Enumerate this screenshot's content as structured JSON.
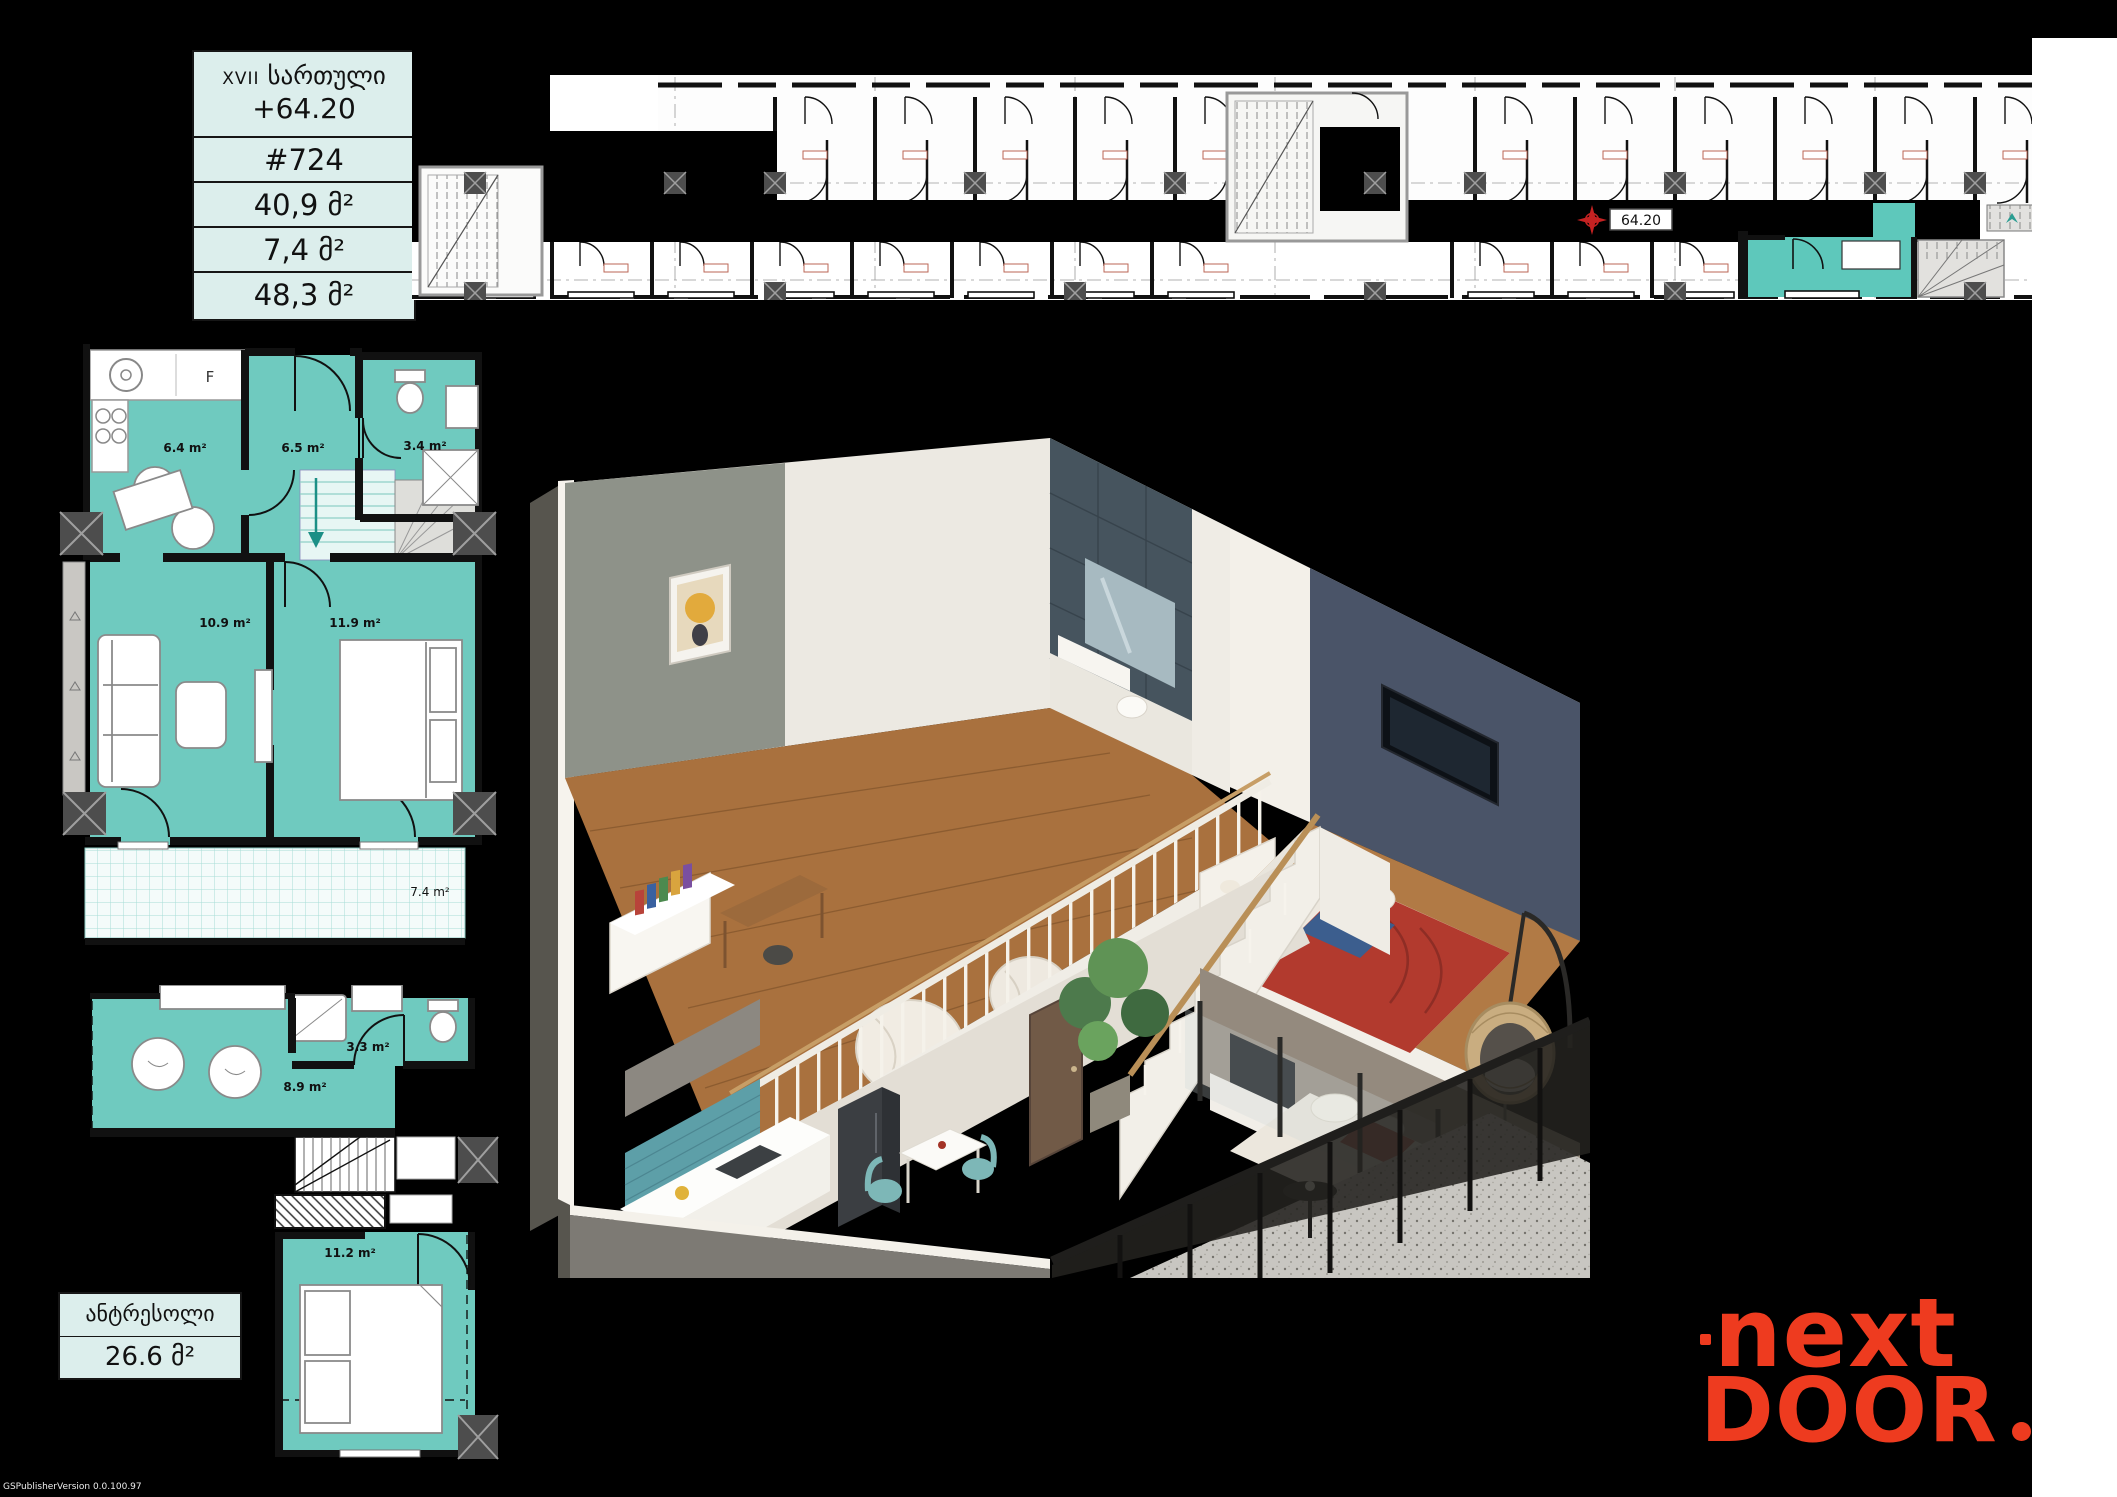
{
  "colors": {
    "teal_room": "#6fcabf",
    "teal_light_bg": "#dceeec",
    "highlight_unit": "#5ec8bb",
    "logo_orange": "#ee3b1f",
    "plan_black": "#111111"
  },
  "info_table": {
    "floor_roman": "XVII",
    "floor_word": "სართული",
    "elevation": "+64.20",
    "rows": [
      {
        "value": "#724"
      },
      {
        "value": "40,9 მ²"
      },
      {
        "value": "7,4 მ²"
      },
      {
        "value": "48,3 მ²"
      }
    ]
  },
  "building_plan": {
    "marker_label": "64.20"
  },
  "unit_plan": {
    "fridge_label": "F",
    "rooms": [
      {
        "name": "kitchen",
        "area": "6.4 m²"
      },
      {
        "name": "hall",
        "area": "6.5 m²"
      },
      {
        "name": "bathroom",
        "area": "3.4 m²"
      },
      {
        "name": "living",
        "area": "10.9 m²"
      },
      {
        "name": "bedroom",
        "area": "11.9 m²"
      },
      {
        "name": "balcony",
        "area": "7.4 m²"
      }
    ]
  },
  "mezzanine_plan": {
    "label": "ანტრესოლი",
    "total_area": "26.6 მ²",
    "rooms": [
      {
        "name": "bathroom",
        "area": "3.3 m²"
      },
      {
        "name": "hall",
        "area": "8.9 m²"
      },
      {
        "name": "bedroom",
        "area": "11.2 m²"
      }
    ]
  },
  "logo": {
    "line1": "next",
    "line2": "DOOR"
  },
  "watermark": "GSPublisherVersion 0.0.100.97"
}
